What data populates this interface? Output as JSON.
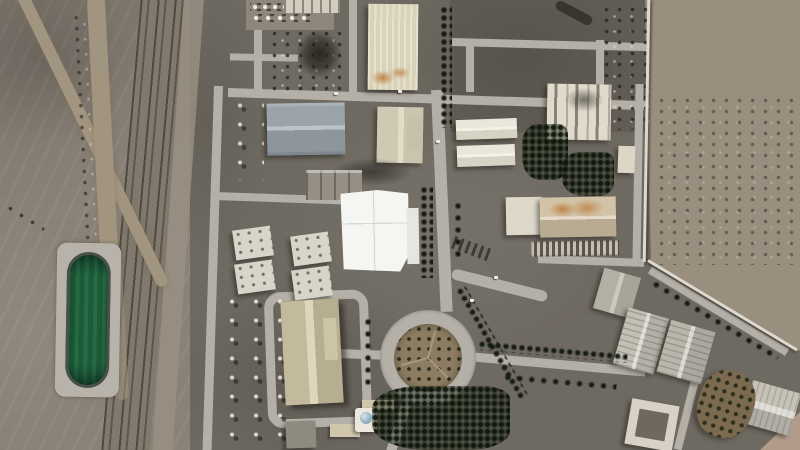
{
  "image": {
    "kind": "satellite-photo",
    "subject": "Overhead satellite view of a fenced desert industrial complex with warehouses, a bright white central hall, tree-lined roads, a circular landscaped roundabout, a railway corridor and a green water reservoir",
    "visible_text": []
  },
  "palette": {
    "desert": "#8a8177",
    "desertDark": "#776e63",
    "desertRight": "#9a8f7f",
    "sand": "#b19c8a",
    "ground": "#6f6a61",
    "road": "#b4b0a7",
    "railbed": "#81796d",
    "dirt": "#a2957f",
    "apron": "#b8b3aa",
    "rim": "#49504a",
    "water": "#1d5c3a",
    "beige": "#d9d2b7",
    "blueg": "#9aa4aa",
    "cream": "#d9d3bf",
    "tanroof": "#cfc6a9",
    "stain": "#bf8449",
    "white": "#f5f5f2",
    "grayflat": "#8f8a80",
    "wall": "#ded9cf",
    "dome": "#8fb0c4",
    "mound": "#7b6a50"
  },
  "features": {
    "reservoir": {
      "label": "Lined water reservoir with green water"
    },
    "railway": {
      "label": "Railway corridor with parallel tracks"
    },
    "dirt_road": {
      "label": "Diagonal desert dirt track"
    },
    "central_hall": {
      "label": "Large bright white-roofed central hall"
    },
    "beige_warehouse": {
      "label": "Large beige ribbed-roof warehouse"
    },
    "blue_warehouse": {
      "label": "Blue-gray double-gable warehouse"
    },
    "damaged_building": {
      "label": "Light building with darkened roof streaks"
    },
    "stained_building": {
      "label": "Tan building with rust-stained roof"
    },
    "tan_warehouse": {
      "label": "Tan gable warehouse inside loop road"
    },
    "roundabout": {
      "label": "Landscaped traffic roundabout"
    },
    "park": {
      "label": "Dense evergreen planting"
    },
    "perimeter_wall": {
      "label": "Perimeter security wall"
    },
    "desert": {
      "label": "Open desert terrain"
    },
    "courtyard_building": {
      "label": "Square building with inner courtyard"
    },
    "mosque": {
      "label": "Small domed building in walled compound"
    }
  }
}
